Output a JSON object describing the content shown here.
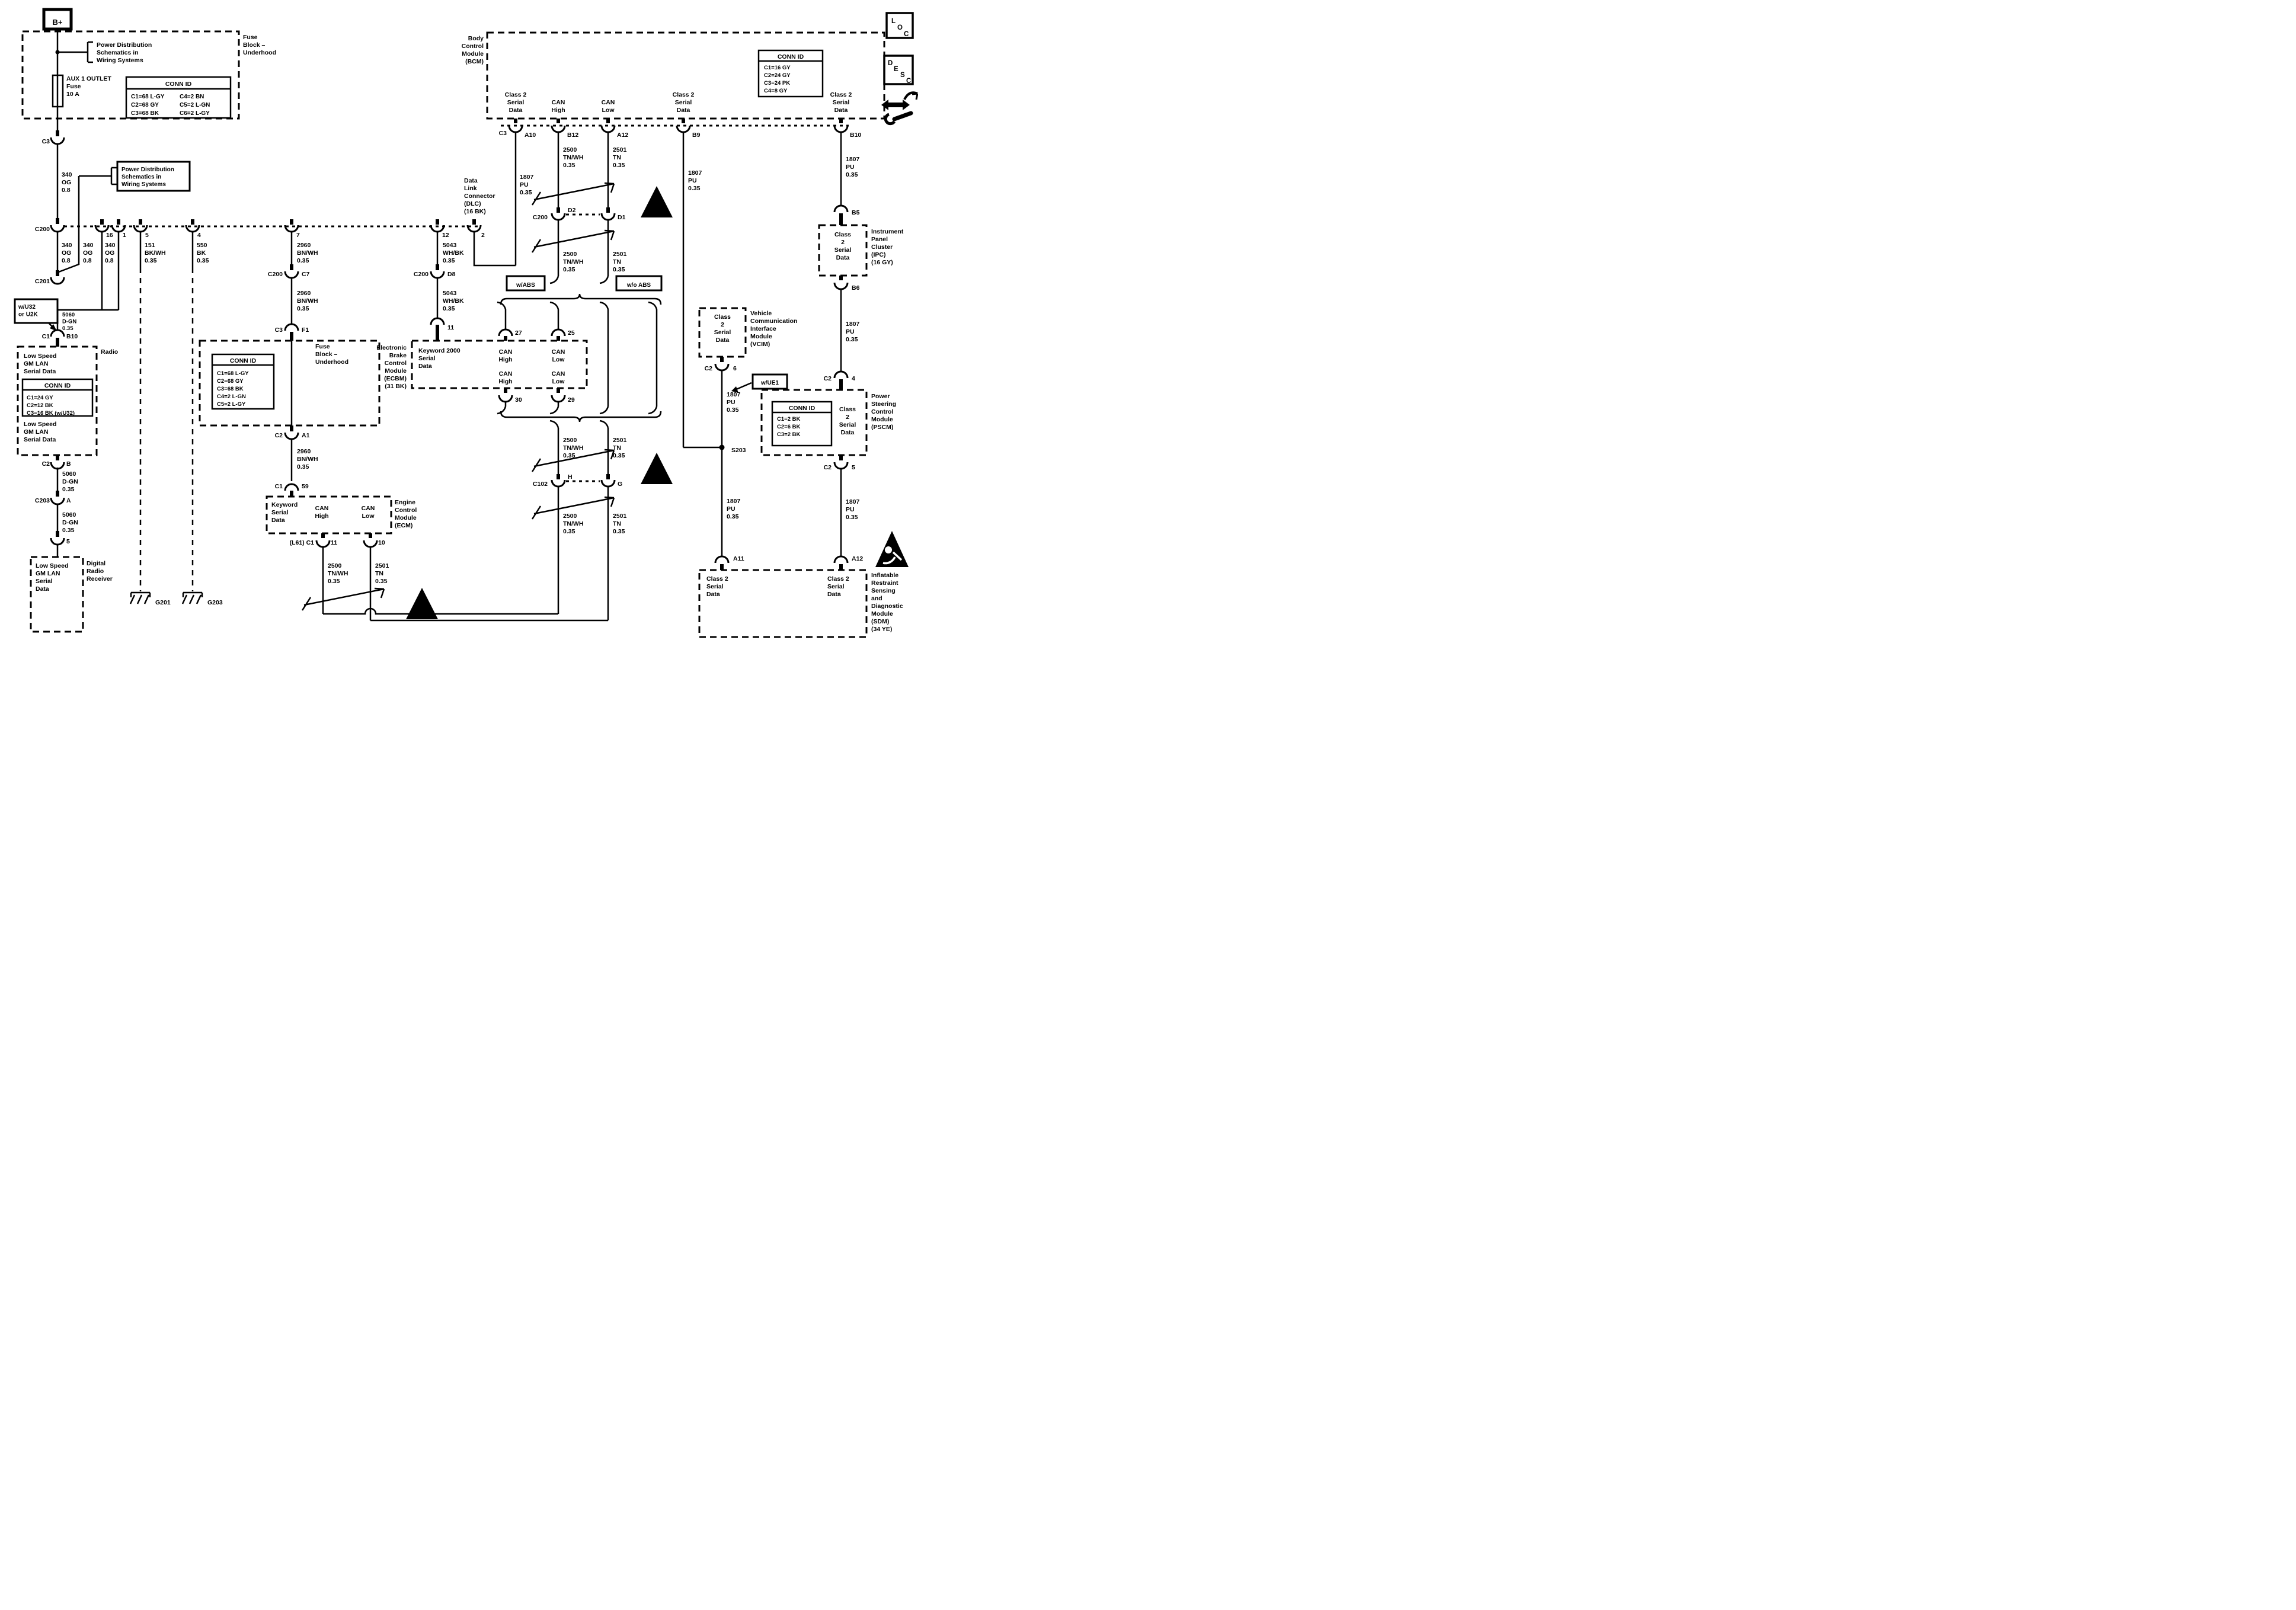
{
  "icons": {
    "loc": [
      "L",
      "O",
      "C"
    ],
    "desc": [
      "D",
      "E",
      "S",
      "C"
    ]
  },
  "common": {
    "conn_id": "CONN ID",
    "warn": "!"
  },
  "left": {
    "bplus": "B+",
    "fuse_block1": {
      "label": "Fuse\nBlock –\nUnderhood",
      "fuse": "AUX 1 OUTLET\nFuse\n10 A",
      "conn_table": [
        "C1=68 L-GY",
        "C2=68 GY",
        "C3=68 BK",
        "C4=2 BN",
        "C5=2 L-GN",
        "C6=2 L-GY"
      ]
    },
    "power_dist1": "Power Distribution\nSchematics in\nWiring Systems",
    "power_dist2": "Power Distribution\nSchematics in\nWiring Systems",
    "c3": "C3",
    "c200": "C200",
    "c201": "C201",
    "wire_340": "340\nOG\n0.8",
    "row_pins": {
      "p16": "16",
      "p1": "1",
      "p5": "5",
      "p4": "4",
      "p7": "7",
      "p12": "12",
      "p2": "2"
    },
    "wire_151": "151\nBK/WH\n0.35",
    "wire_550": "550\nBK\n0.35",
    "w_u32": "w/U32\nor U2K",
    "wire_5060": "5060\nD-GN\n0.35",
    "radio": {
      "label": "Radio",
      "c1": "C1",
      "b10": "B10",
      "c2": "C2",
      "b": "B",
      "lan": "Low Speed\nGM LAN\nSerial Data",
      "conn_table": [
        "C1=24 GY",
        "C2=12 BK",
        "C3=16 BK (w/U32)"
      ]
    },
    "c203": "C203",
    "a": "A",
    "p5b": "5",
    "receiver": {
      "lan": "Low Speed\nGM LAN\nSerial\nData",
      "label": "Digital\nRadio\nReceiver"
    },
    "g201": "G201",
    "g203": "G203"
  },
  "middle": {
    "wire_2960": "2960\nBN/WH\n0.35",
    "wire_5043": "5043\nWH/BK\n0.35",
    "wire_2500": "2500\nTN/WH\n0.35",
    "wire_2501": "2501\nTN\n0.35",
    "c200": "C200",
    "c7": "C7",
    "c3": "C3",
    "f1": "F1",
    "c2": "C2",
    "a1": "A1",
    "c1": "C1",
    "n59": "59",
    "fuse_block2": {
      "label": "Fuse\nBlock –\nUnderhood",
      "conn_table": [
        "C1=68 L-GY",
        "C2=68 GY",
        "C3=68 BK",
        "C4=2 L-GN",
        "C5=2 L-GY"
      ]
    },
    "ecm": {
      "label": "Engine\nControl\nModule\n(ECM)",
      "keyword": "Keyword\nSerial\nData",
      "can_high": "CAN\nHigh",
      "can_low": "CAN\nLow",
      "l61": "(L61) C1",
      "p11": "11",
      "p10": "10"
    },
    "ecbm": {
      "label": "Electronic\nBrake\nControl\nModule\n(ECBM)\n(31 BK)",
      "keyword": "Keyword 2000\nSerial\nData",
      "can_high": "CAN\nHigh",
      "can_low": "CAN\nLow",
      "c200": "C200",
      "d8": "D8",
      "p11": "11",
      "p27": "27",
      "p25": "25",
      "p30": "30",
      "p29": "29"
    },
    "dlc": {
      "label": "Data\nLink\nConnector\n(DLC)\n(16 BK)"
    }
  },
  "right": {
    "bcm": {
      "label": "Body\nControl\nModule\n(BCM)",
      "class2": "Class 2\nSerial\nData",
      "can_high": "CAN\nHigh",
      "can_low": "CAN\nLow",
      "conn_table": [
        "C1=16 GY",
        "C2=24 GY",
        "C3=24 PK",
        "C4=8 GY"
      ],
      "c3": "C3",
      "a10": "A10",
      "b12": "B12",
      "a12": "A12",
      "b9": "B9",
      "b10": "B10"
    },
    "wire_1807": "1807\nPU\n0.35",
    "w_abs": "w/ABS",
    "wo_abs": "w/o ABS",
    "c200": "C200",
    "d2": "D2",
    "d1": "D1",
    "c102": "C102",
    "h": "H",
    "g": "G",
    "ipc": {
      "label": "Instrument\nPanel\nCluster\n(IPC)\n(16 GY)",
      "class2": "Class\n2\nSerial\nData",
      "b5": "B5",
      "b6": "B6"
    },
    "vcim": {
      "label": "Vehicle\nCommunication\nInterface\nModule\n(VCIM)",
      "class2": "Class\n2\nSerial\nData",
      "c2": "C2",
      "p6": "6",
      "w_ue1": "w/UE1",
      "s203": "S203"
    },
    "pscm": {
      "label": "Power\nSteering\nControl\nModule\n(PSCM)",
      "class2": "Class\n2\nSerial\nData",
      "conn_table": [
        "C1=2 BK",
        "C2=6 BK",
        "C3=2 BK"
      ],
      "c2": "C2",
      "p4": "4",
      "p5": "5"
    },
    "sdm": {
      "label": "Inflatable\nRestraint\nSensing\nand\nDiagnostic\nModule\n(SDM)\n(34 YE)",
      "class2": "Class 2\nSerial\nData",
      "a11": "A11",
      "a12": "A12"
    }
  }
}
